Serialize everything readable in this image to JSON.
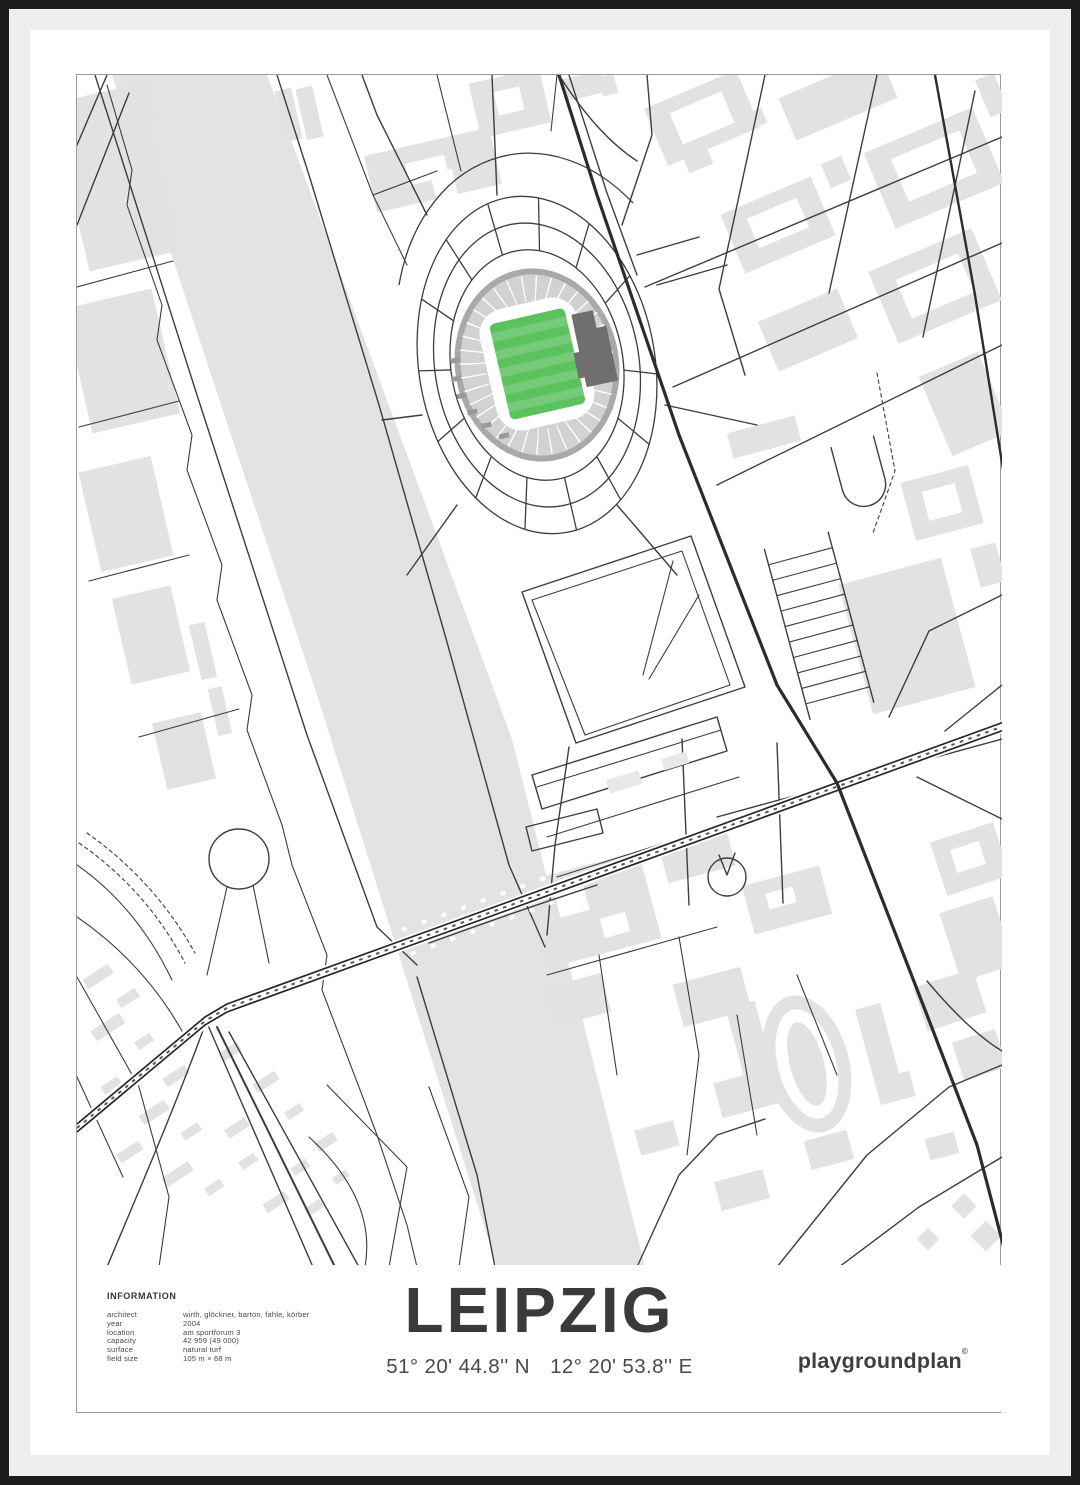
{
  "poster": {
    "title": "LEIPZIG",
    "coordinates": {
      "lat": "51° 20' 44.8'' N",
      "lon": "12° 20' 53.8'' E"
    },
    "brand": "playgroundplan",
    "brand_mark": "©",
    "info": {
      "heading": "INFORMATION",
      "rows": [
        {
          "label": "architect",
          "value": "wirth, glöckner, barton, fahle, körber"
        },
        {
          "label": "year",
          "value": "2004"
        },
        {
          "label": "location",
          "value": "am sportforum 3"
        },
        {
          "label": "capacity",
          "value": "42 959 (49 000)"
        },
        {
          "label": "surface",
          "value": "natural turf"
        },
        {
          "label": "field size",
          "value": "105 m × 68 m"
        }
      ]
    },
    "map": {
      "description": "minimalist street map of the red bull arena / sportforum area of leipzig with stadium pitch highlighted in green",
      "colors": {
        "pitch_green": "#5bc25e",
        "pitch_stripe": "rgba(255,255,255,0.16)",
        "water": "#e3e3e3",
        "building": "#e2e2e2",
        "building_light": "#e8e8e8",
        "road": "#3d3d3d",
        "road_heavy": "#2c2c2c",
        "stand": "#d2d2d2",
        "stand_rim": "#a9a9a9",
        "stand_dark": "#6f6f6f",
        "frame": "#1c1c1c",
        "matte": "#eeeeee",
        "text": "#3c3c3c"
      }
    }
  }
}
